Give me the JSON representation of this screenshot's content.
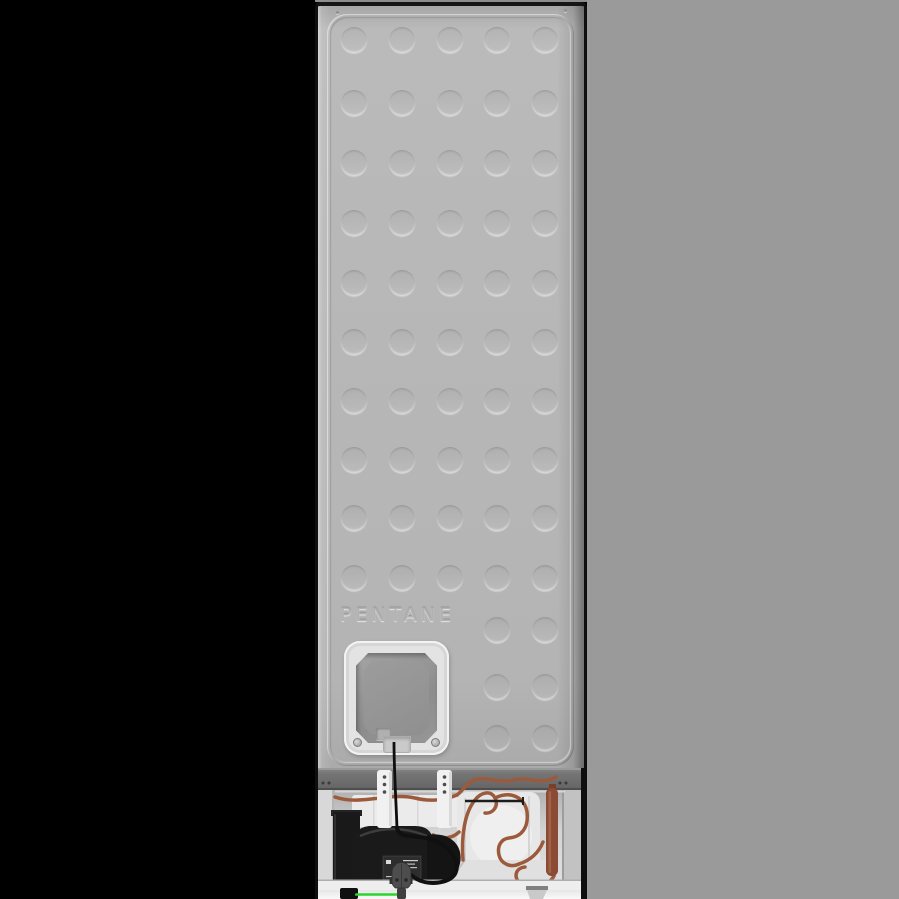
{
  "meta": {
    "subject": "Rear view of a freestanding fridge freezer (product photo)"
  },
  "panel": {
    "embossed_text": "PENTANE"
  },
  "decor": {
    "dimples": {
      "diameter": 26,
      "column_centers_x": [
        36,
        84,
        132,
        179,
        227
      ],
      "full_row_centers_y": [
        34,
        97,
        157,
        217,
        277,
        336,
        395,
        454,
        512,
        572
      ],
      "partial_row_centers_y": [
        624,
        681,
        732
      ],
      "partial_column_centers_x": [
        179,
        227
      ]
    }
  },
  "colors": {
    "background_left": "#000000",
    "background_right": "#9a9a9a",
    "panel_gray": "#b6b6b6",
    "edge_black": "#0f0f0f",
    "compartment_gray": "#cccccc",
    "white_parts": "#ececec",
    "copper_tube": "#9c5a3d",
    "drier_copper": "#8a4a33",
    "compressor_black": "#1b1b1b",
    "power_plug_gray": "#4d4d4d",
    "earth_wire_green": "#2bd52b",
    "warning_yellow": "#e3bf1e"
  },
  "machinery": {
    "parts": [
      "compressor",
      "compressor-relay-box",
      "warning-label",
      "condenser-tubing",
      "drier-filter",
      "mounting-brackets",
      "foam-fan-housing",
      "drain-tray",
      "power-cord",
      "power-plug",
      "earth-wire",
      "feet"
    ]
  }
}
